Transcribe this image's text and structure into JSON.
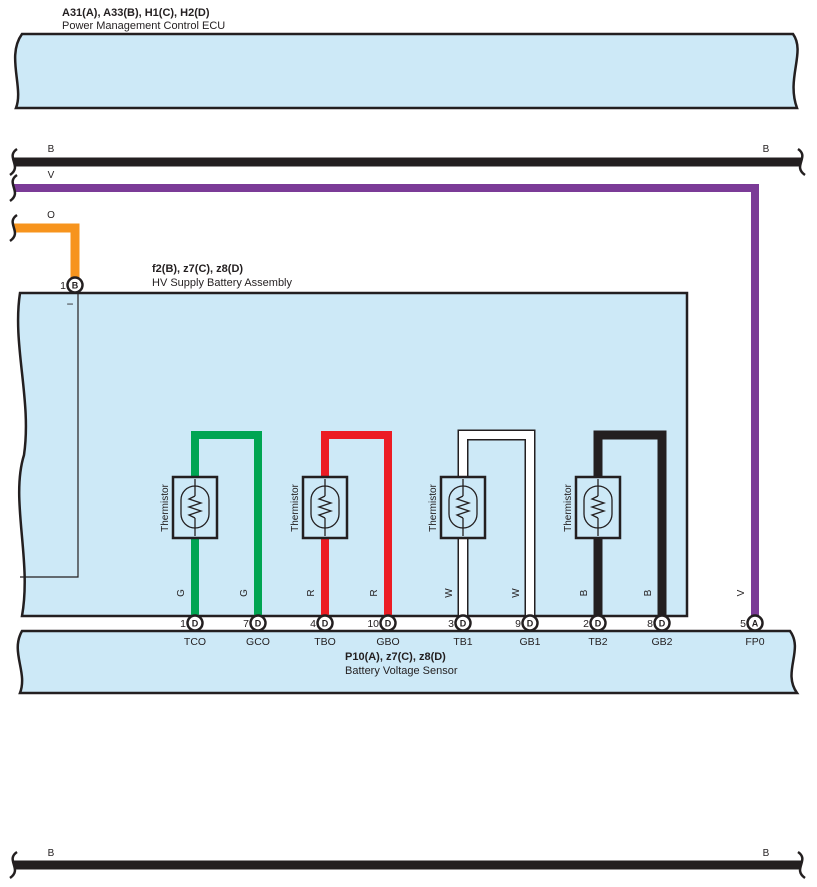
{
  "colors": {
    "band_fill": "#cde9f7",
    "outline": "#231f20",
    "wire_black": "#231f20",
    "wire_violet": "#7b3b97",
    "wire_orange": "#f7941d",
    "wire_green": "#00a552",
    "wire_red": "#ec1c24",
    "wire_white": "#ffffff"
  },
  "ecu": {
    "code": "A31(A), A33(B), H1(C), H2(D)",
    "name": "Power Management Control ECU"
  },
  "bus_wires": {
    "top_black": {
      "color_code_left": "B",
      "color_code_right": "B"
    },
    "violet": {
      "color_code": "V"
    },
    "orange": {
      "color_code": "O"
    },
    "bottom_black": {
      "color_code_left": "B",
      "color_code_right": "B"
    }
  },
  "hv_battery": {
    "code": "f2(B), z7(C), z8(D)",
    "name": "HV Supply Battery Assembly",
    "minus_label": "−",
    "ground_pin": {
      "pin": "1",
      "connector": "B"
    },
    "thermistors": [
      {
        "label": "Thermistor"
      },
      {
        "label": "Thermistor"
      },
      {
        "label": "Thermistor"
      },
      {
        "label": "Thermistor"
      }
    ]
  },
  "sensor": {
    "code": "P10(A), z7(C), z8(D)",
    "name": "Battery Voltage Sensor"
  },
  "pins": [
    {
      "pin": "1",
      "connector": "D",
      "terminal": "TCO",
      "wire_color": "G"
    },
    {
      "pin": "7",
      "connector": "D",
      "terminal": "GCO",
      "wire_color": "G"
    },
    {
      "pin": "4",
      "connector": "D",
      "terminal": "TBO",
      "wire_color": "R"
    },
    {
      "pin": "10",
      "connector": "D",
      "terminal": "GBO",
      "wire_color": "R"
    },
    {
      "pin": "3",
      "connector": "D",
      "terminal": "TB1",
      "wire_color": "W"
    },
    {
      "pin": "9",
      "connector": "D",
      "terminal": "GB1",
      "wire_color": "W"
    },
    {
      "pin": "2",
      "connector": "D",
      "terminal": "TB2",
      "wire_color": "B"
    },
    {
      "pin": "8",
      "connector": "D",
      "terminal": "GB2",
      "wire_color": "B"
    },
    {
      "pin": "5",
      "connector": "A",
      "terminal": "FP0",
      "wire_color": "V"
    }
  ]
}
